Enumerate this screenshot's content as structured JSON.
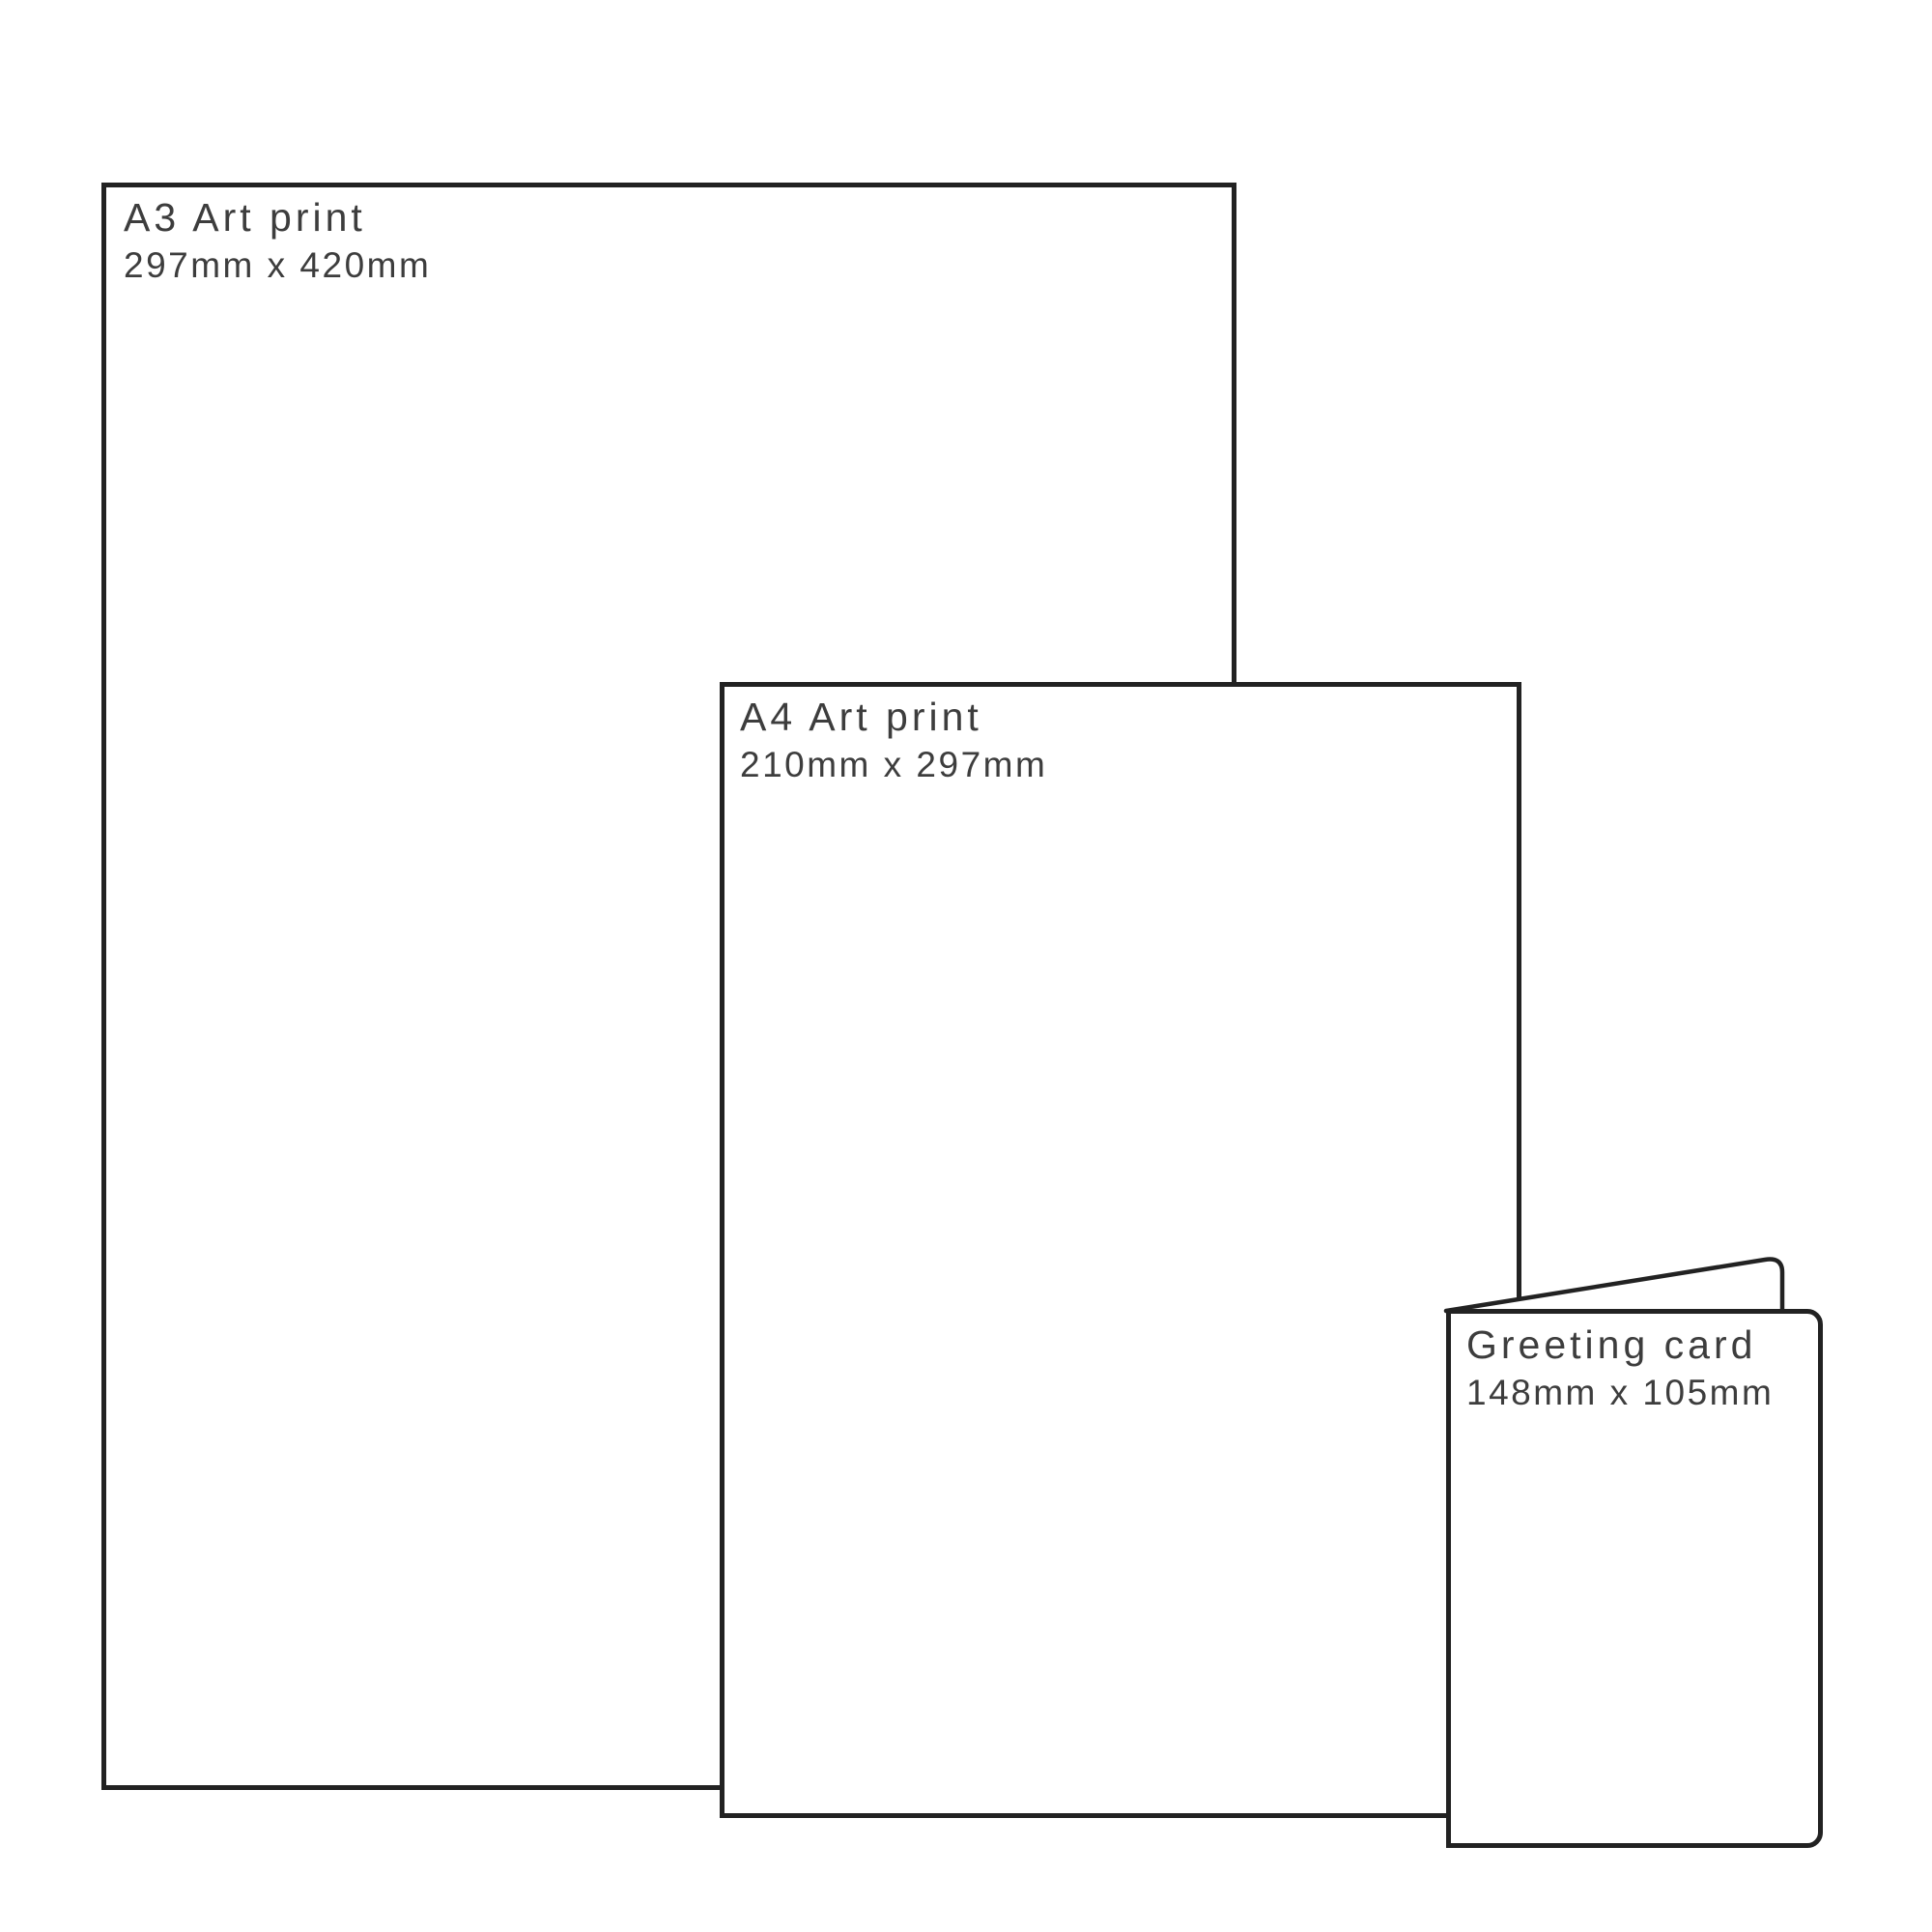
{
  "canvas": {
    "background_color": "#ffffff",
    "outline_color": "#222222",
    "label_color": "#3d3d3d"
  },
  "items": [
    {
      "id": "a3-art-print",
      "title": "A3 Art print",
      "dimensions": "297mm x 420mm",
      "shape": "rectangle-outline"
    },
    {
      "id": "a4-art-print",
      "title": "A4 Art print",
      "dimensions": "210mm x 297mm",
      "shape": "rectangle-outline"
    },
    {
      "id": "greeting-card",
      "title": "Greeting card",
      "dimensions": "148mm x 105mm",
      "shape": "folded-card-outline"
    }
  ]
}
